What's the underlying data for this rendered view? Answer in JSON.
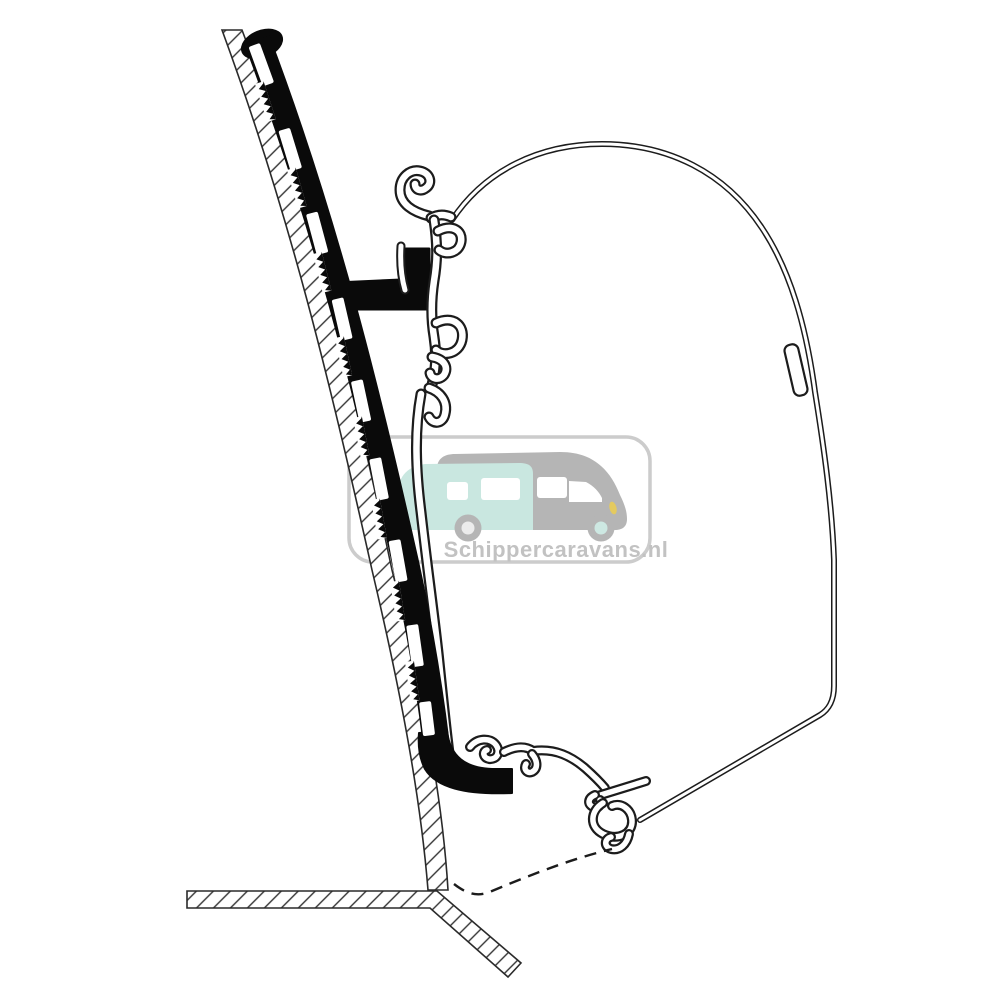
{
  "page": {
    "background_color": "#ffffff"
  },
  "diagram": {
    "ink_color": "#1c1c1c",
    "adapter_color": "#0a0a0a",
    "hatch_color": "#333333",
    "parts": {
      "wall": "vehicle-wall-cross-section",
      "adapter": "adapter-profile",
      "top_rail": "awning-mounting-rail",
      "case": "awning-case-outline",
      "bottom_rail": "awning-bottom-rail",
      "roof": "roof-cross-section",
      "reference_line": "dashed-reference-line"
    }
  },
  "watermark": {
    "text": "Schippercaravans.nl",
    "text_color": "#c2c2c2",
    "border_color": "#cccccc",
    "motorhome": {
      "body_color": "#c9e7e0",
      "cab_color": "#b5b5b5",
      "window_color": "#ffffff",
      "wheel_color": "#b5b5b5",
      "rear_hub_color": "#ececec",
      "front_hub_color": "#cde8e2",
      "headlight_color": "#e4ca5f"
    }
  }
}
